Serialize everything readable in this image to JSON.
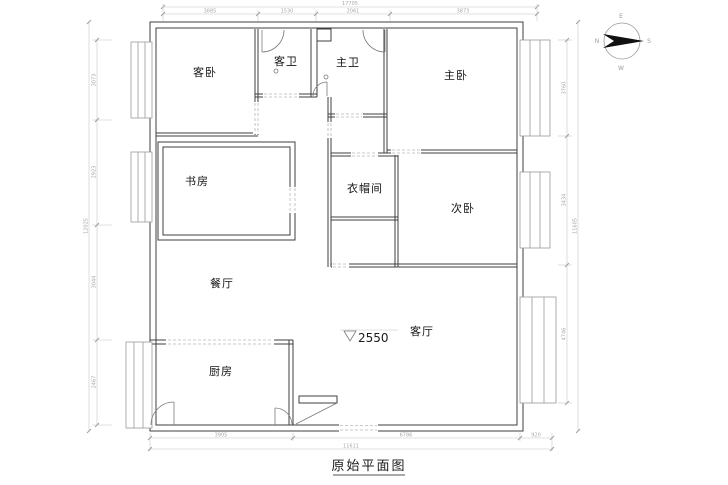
{
  "title": {
    "text": "原始平面图"
  },
  "elevation": {
    "value": "2550"
  },
  "compass": {
    "top": "E",
    "left": "N",
    "right": "S",
    "bottom": "W"
  },
  "rooms": {
    "guest_bedroom": "客卧",
    "guest_bath": "客卫",
    "master_bath": "主卫",
    "master_bedroom": "主卧",
    "study": "书房",
    "cloakroom": "衣帽间",
    "second_bedroom": "次卧",
    "dining": "餐厅",
    "living": "客厅",
    "kitchen": "厨房"
  },
  "dims": {
    "top": {
      "overall": "17705",
      "segments": [
        "3885",
        "1530",
        "2061",
        "3873"
      ]
    },
    "bottom": {
      "overall": "11611",
      "segments": [
        "3905",
        "6786",
        "920"
      ]
    },
    "left": {
      "overall": "12025",
      "segments": [
        "3073",
        "2923",
        "3044",
        "2467"
      ]
    },
    "right": {
      "overall": "11605",
      "segments": [
        "3760",
        "3434",
        "4746"
      ]
    }
  }
}
